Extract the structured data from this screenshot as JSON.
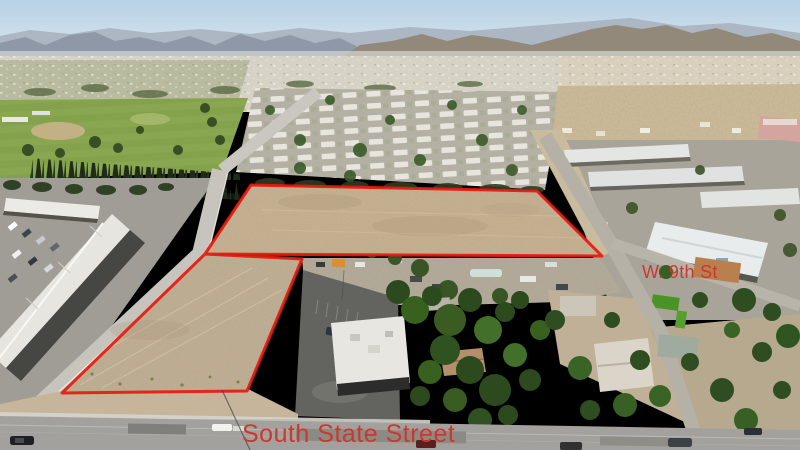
{
  "scene": {
    "description": "Aerial drone photograph of two vacant dirt parcels outlined in red at a street corner",
    "labels": {
      "main_street": "South State Street",
      "cross_street": "W. 9th St"
    },
    "colors": {
      "street_label_red": "#ce372c",
      "boundary_red": "#e8190e",
      "sky_blue": "#bed6e8",
      "dirt_tan": "#c5b091",
      "park_green": "#84a24c"
    }
  }
}
